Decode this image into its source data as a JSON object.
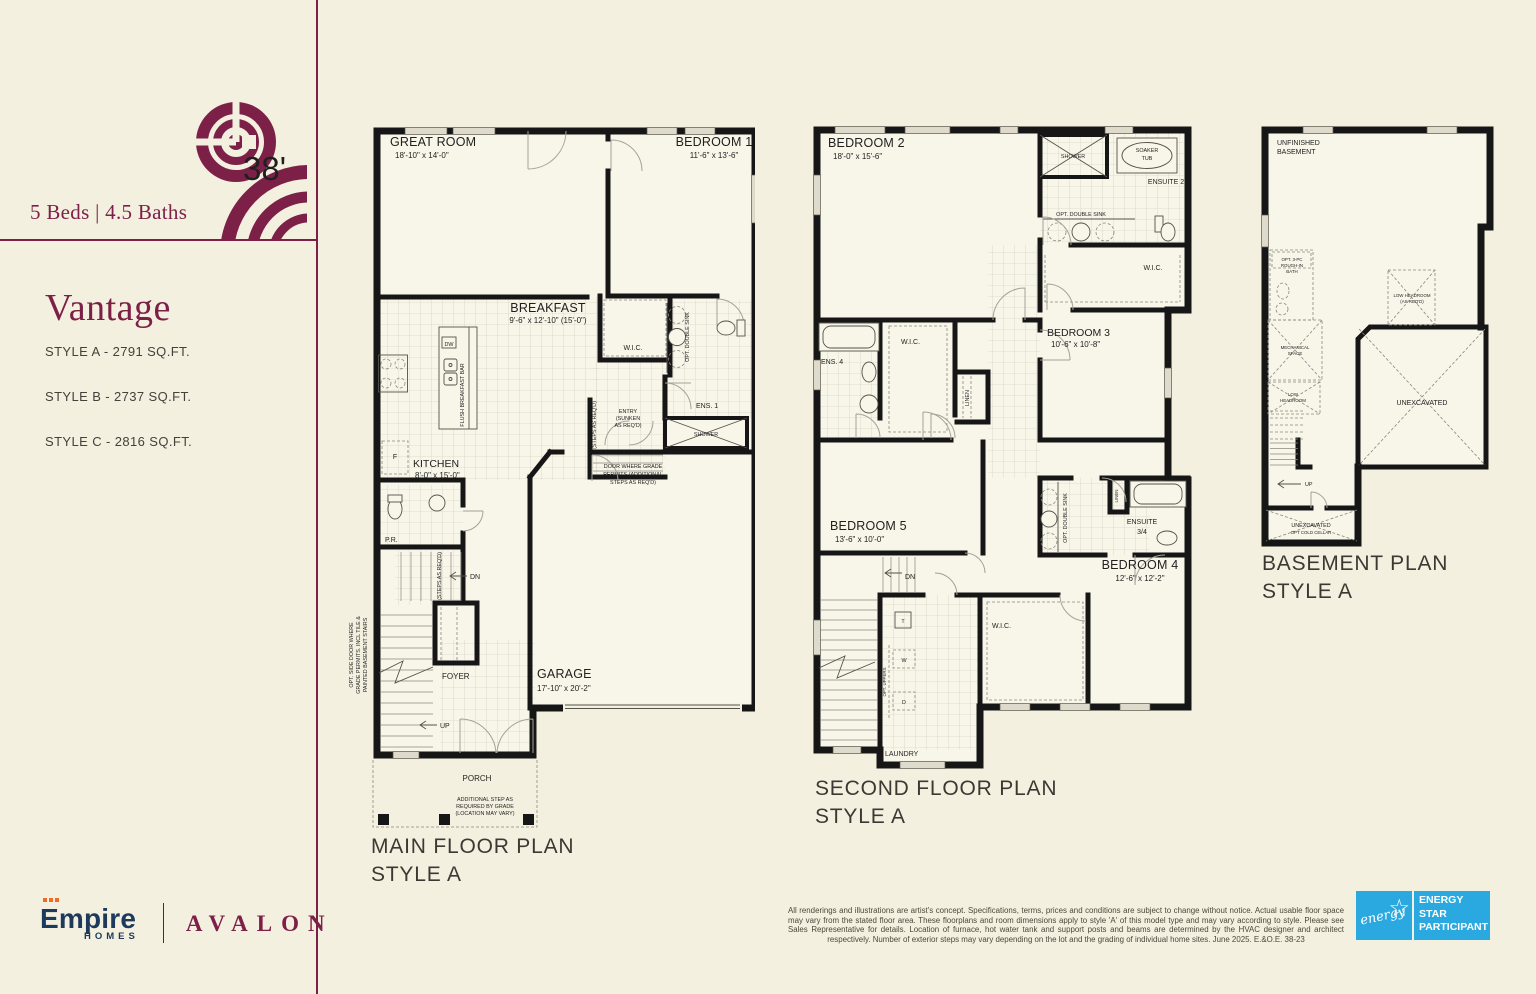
{
  "sidebar": {
    "lot_width": "38'",
    "beds_baths": "5 Beds  |  4.5 Baths",
    "model_name": "Vantage",
    "style_a": "STYLE A - 2791 SQ.FT.",
    "style_b": "STYLE B - 2737 SQ.FT.",
    "style_c": "STYLE C - 2816 SQ.FT.",
    "brand_name": "Empire",
    "brand_sub": "HOMES",
    "community": "AVALON"
  },
  "plans": {
    "main": {
      "title": "MAIN FLOOR PLAN",
      "style": "STYLE A",
      "labels": {
        "great_room_name": "GREAT ROOM",
        "great_room_dim": "18'-10\" x 14'-0\"",
        "bedroom1_name": "BEDROOM 1",
        "bedroom1_dim": "11'-6\" x 13'-6\"",
        "breakfast_name": "BREAKFAST",
        "breakfast_dim": "9'-6\" x 12'-10\" (15'-0\")",
        "wic": "W.I.C.",
        "opt_double_sink": "OPT. DOUBLE SINK",
        "ens1": "ENS. 1",
        "shower": "SHOWER",
        "entry_l1": "ENTRY",
        "entry_l2": "(SUNKEN",
        "entry_l3": "AS REQ'D)",
        "steps_reqd": "(STEPS AS REQ'D)",
        "dw": "DW",
        "flush_bar": "FLUSH BREAKFAST BAR",
        "fridge": "F",
        "kitchen_name": "KITCHEN",
        "kitchen_dim": "8'-0\" x 15'-0\"",
        "pr": "P.R.",
        "dn": "DN",
        "up": "UP",
        "foyer": "FOYER",
        "garage_name": "GARAGE",
        "garage_dim": "17'-10\" x 20'-2\"",
        "door_grade_l1": "DOOR WHERE GRADE",
        "door_grade_l2": "PERMITS (ADDITIONAL",
        "door_grade_l3": "STEPS AS REQ'D)",
        "porch": "PORCH",
        "addl_l1": "ADDITIONAL STEP AS",
        "addl_l2": "REQUIRED BY GRADE",
        "addl_l3": "(LOCATION MAY VARY)",
        "side_door_l1": "OPT. SIDE DOOR WHERE",
        "side_door_l2": "GRADE PERMITS. INCL TILE &",
        "side_door_l3": "PAINTED BASEMENT STAIRS"
      }
    },
    "second": {
      "title": "SECOND FLOOR PLAN",
      "style": "STYLE A",
      "labels": {
        "bedroom2_name": "BEDROOM 2",
        "bedroom2_dim": "18'-0\" x 15'-6\"",
        "shower": "SHOWER",
        "soaker_l1": "SOAKER",
        "soaker_l2": "TUB",
        "ensuite2": "ENSUITE 2",
        "opt_double_sink": "OPT. DOUBLE SINK",
        "wic": "W.I.C.",
        "bedroom3_name": "BEDROOM 3",
        "bedroom3_dim": "10'-6\" x 10'-8\"",
        "ens4": "ENS. 4",
        "linen": "LINEN",
        "bedroom5_name": "BEDROOM 5",
        "bedroom5_dim": "13'-6\" x 10'-0\"",
        "dn": "DN",
        "ensuite34_l1": "ENSUITE",
        "ensuite34_l2": "3/4",
        "bedroom4_name": "BEDROOM 4",
        "bedroom4_dim": "12'-6\" x 12'-2\"",
        "t": "T",
        "w": "W",
        "d": "D",
        "opt_uppers": "OPT. UPPERS",
        "laundry": "LAUNDRY"
      }
    },
    "basement": {
      "title": "BASEMENT PLAN",
      "style": "STYLE A",
      "labels": {
        "unfinished_l1": "UNFINISHED",
        "unfinished_l2": "BASEMENT",
        "rough_l1": "OPT. 3-PC",
        "rough_l2": "ROUGH-IN",
        "rough_l3": "BATH",
        "lowhead_l1": "LOW HEADROOM",
        "lowhead_l2": "(AS REQ'D)",
        "mech_l1": "MECHANICAL",
        "mech_l2": "SPACE",
        "lowhead2_l1": "LOW",
        "lowhead2_l2": "HEADROOM",
        "unexcavated": "UNEXCAVATED",
        "up": "UP",
        "cold_l1": "UNEXCAVATED",
        "cold_l2": "OPT COLD CELLAR"
      }
    }
  },
  "footer": {
    "disclaimer": "All renderings and illustrations are artist's concept. Specifications, terms, prices and conditions are subject to change without notice. Actual usable floor space may vary from the stated floor area. These floorplans and room dimensions apply to style 'A' of this model type and may vary according to style. Please see Sales Representative for details. Location of furnace, hot water tank and support posts and beams are determined by the HVAC designer and architect respectively. Number of exterior steps may vary depending on the lot and the grading of individual home sites. June 2025. E.&O.E. 38-23",
    "energy": {
      "script": "energy",
      "line1": "ENERGY",
      "line2": "STAR",
      "line3": "PARTICIPANT"
    }
  },
  "colors": {
    "maroon": "#7d2048",
    "navy": "#1d3a5c",
    "orange": "#f26b22",
    "energy_blue": "#2aa9e0",
    "cream": "#f4f0e0",
    "wall": "#161616"
  }
}
